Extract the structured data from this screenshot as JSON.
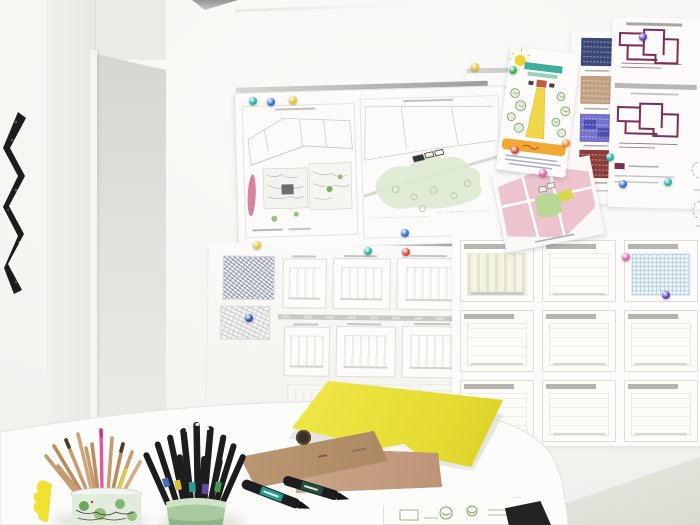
{
  "meta": {
    "scene": "architecture studio photo: wall of pinned plans and drawings above a white round desk with stationery",
    "canvas_w": 700,
    "canvas_h": 525
  },
  "palette": {
    "wall": "#f6f5f2",
    "door_face": "#efeeeb",
    "door_recess": "#d9d8d5",
    "floor": "#e2e1da",
    "desk": "#fcfcfa",
    "rail": "#b3b2af",
    "paper": "#fcfbf9",
    "folder_yellow": "#eae23c",
    "notebook_kraft": "#b7946e",
    "notebook_rose": "#c7a285",
    "cup_green": "#a9caa1",
    "cup_map": "#e3ecdc",
    "pencil_wood": "#c79a6f",
    "pencil_pink": "#e8559a",
    "marker_black": "#1d1d1f",
    "marker_teal": "#2a9a8c",
    "marker_green": "#1f5040",
    "banner_orange": "#f2a832",
    "garden_path": "#f0d84a",
    "hedge_teal": "#3fae9c",
    "plan_purple": "#7c2d52",
    "map_navy": "#3c4878",
    "map_tan": "#c2a183",
    "map_indigo": "#7673cc",
    "map_darkred": "#8c3d3a",
    "site_pink": "#edc3ce",
    "site_green": "#b8d694",
    "veg_green": "#dde9d0",
    "blob_pink": "#d583a0",
    "art_black": "#1c1c1e",
    "object_black": "#232326"
  },
  "wall": {
    "artwork": "black-white zigzag relief",
    "posters": [
      "site plan pin board",
      "garden illustration sheet",
      "figure-ground map strip",
      "purple floor plan sheet",
      "pink master plan sheet",
      "elevation rows poster",
      "section grid poster"
    ],
    "pins": [
      {
        "x": 253,
        "y": 101,
        "color": "#1fb3a8"
      },
      {
        "x": 271,
        "y": 102,
        "color": "#2f6bd8"
      },
      {
        "x": 293,
        "y": 100,
        "color": "#e6c42f"
      },
      {
        "x": 475,
        "y": 67,
        "color": "#e6c42f"
      },
      {
        "x": 513,
        "y": 70,
        "color": "#2fae52"
      },
      {
        "x": 566,
        "y": 143,
        "color": "#ee8f2a"
      },
      {
        "x": 515,
        "y": 150,
        "color": "#e04438"
      },
      {
        "x": 610,
        "y": 157,
        "color": "#1fb3a8"
      },
      {
        "x": 643,
        "y": 37,
        "color": "#5f3ec0"
      },
      {
        "x": 543,
        "y": 173,
        "color": "#e25fa8"
      },
      {
        "x": 257,
        "y": 245,
        "color": "#e6c42f"
      },
      {
        "x": 368,
        "y": 251,
        "color": "#1fb3a8"
      },
      {
        "x": 405,
        "y": 233,
        "color": "#2f6bd8"
      },
      {
        "x": 406,
        "y": 252,
        "color": "#e04438"
      },
      {
        "x": 249,
        "y": 318,
        "color": "#2f4f9e"
      },
      {
        "x": 623,
        "y": 184,
        "color": "#2f6bd8"
      },
      {
        "x": 668,
        "y": 182,
        "color": "#1fb3a8"
      },
      {
        "x": 626,
        "y": 257,
        "color": "#e25fa8"
      },
      {
        "x": 666,
        "y": 295,
        "color": "#5f3ec0"
      }
    ]
  },
  "desk": {
    "items": [
      "colored pencils in map-print cup",
      "yellow rubber blob",
      "black brush markers in green cup",
      "two kraft notebooks",
      "white sheets",
      "yellow folder",
      "two black chisel markers",
      "sketch card",
      "black wedge object"
    ],
    "marker_band_colors": [
      "#d8c23a",
      "#2f9a92",
      "#5f4a9e",
      "#4a9a52",
      "#4a6ab8"
    ],
    "pencil_count": 13,
    "marker_count": 12
  }
}
